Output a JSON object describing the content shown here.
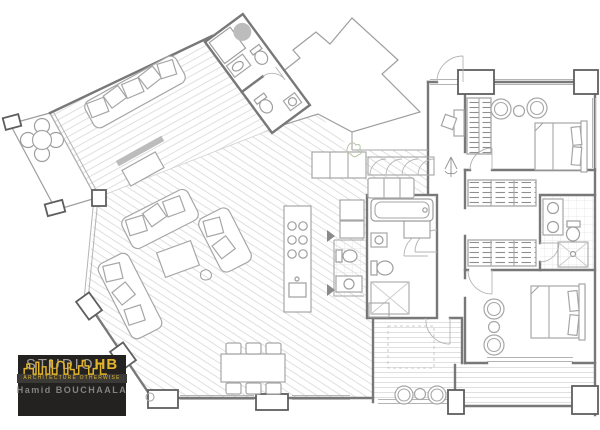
{
  "logo": {
    "studio": "STUDIO",
    "hb": "HB",
    "tagline": "ARCHITECTURE OTHERWISE",
    "author": "Hamid BOUCHAALA"
  },
  "theme": {
    "logo-bg": "#232220",
    "logo-accent": "#e3b52c",
    "logo-muted": "#9f9e9c",
    "logo-tagline-bg": "#3c3a37",
    "wall": "#787878",
    "line": "#a6a6a6",
    "fixture": "#9e9e9e",
    "glass": "#b4b4b4",
    "hatch": "#dcdcdc",
    "plant": "#b5c4a4",
    "paper": "#ffffff"
  }
}
